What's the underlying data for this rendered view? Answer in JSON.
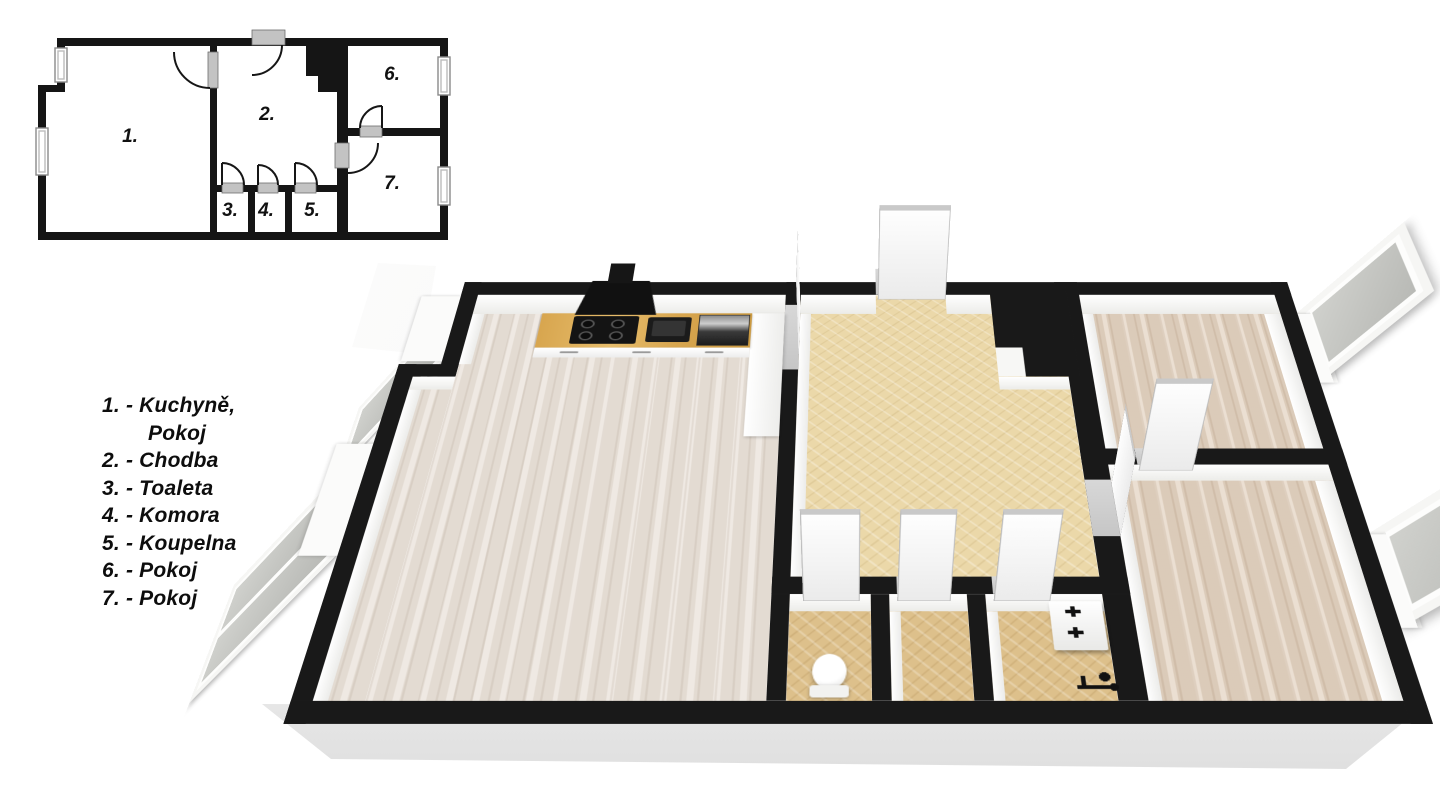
{
  "legend": {
    "items": [
      {
        "line": "1. - Kuchyně,",
        "line2": "Pokoj"
      },
      {
        "line": "2. - Chodba"
      },
      {
        "line": "3. - Toaleta"
      },
      {
        "line": "4. - Komora"
      },
      {
        "line": "5. - Koupelna"
      },
      {
        "line": "6. - Pokoj"
      },
      {
        "line": "7. - Pokoj"
      }
    ]
  },
  "rooms2d": {
    "labels": [
      "1.",
      "2.",
      "3.",
      "4.",
      "5.",
      "6.",
      "7."
    ]
  },
  "colors": {
    "wall": "#191919",
    "floor_wood_main": "#e8e0d7",
    "floor_wood_bedroom": "#e2d1bf",
    "floor_tile": "#ebd8a9",
    "floor_tile_dark": "#ddc08b",
    "counter_wood": "#d8a64f",
    "threshold": "#c6c6c6",
    "door_cap": "#c9c9c9",
    "glass": "#b9bab6"
  }
}
